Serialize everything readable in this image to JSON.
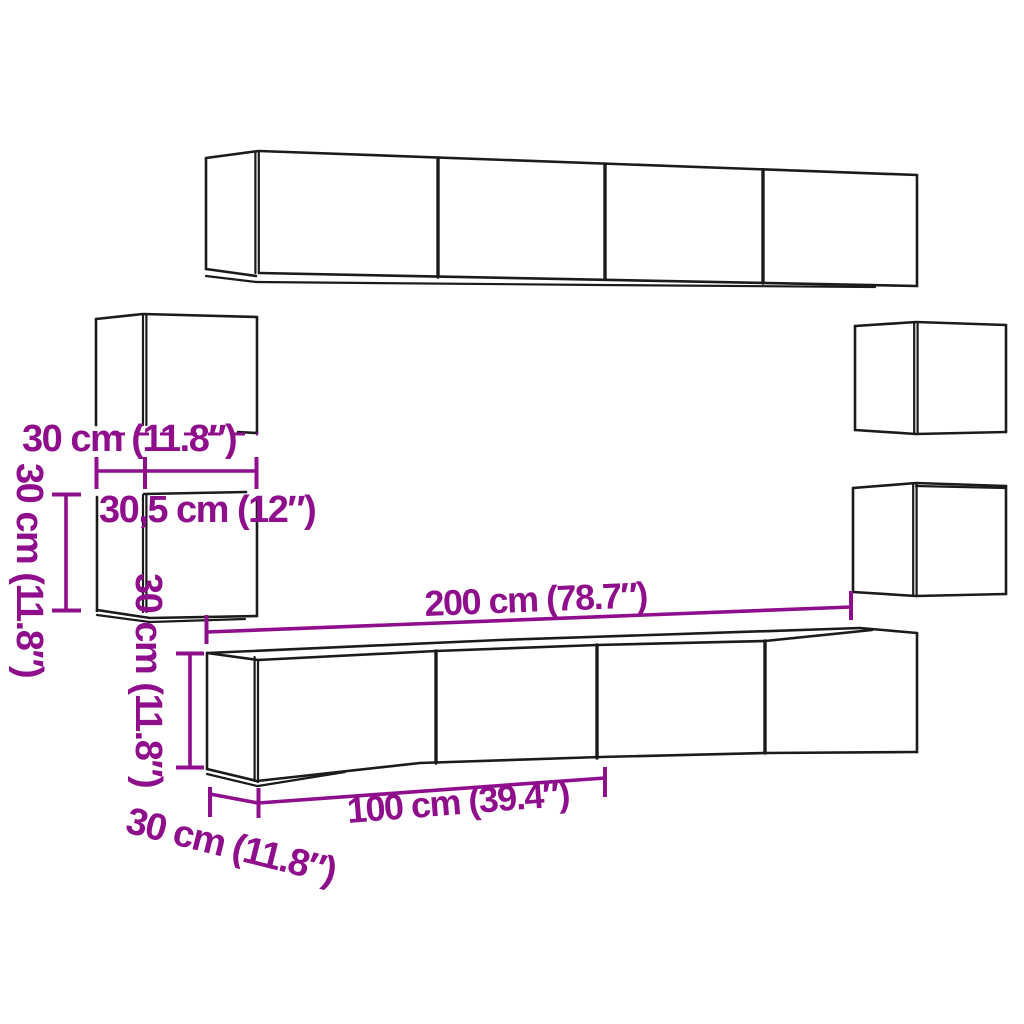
{
  "diagram": {
    "type": "furniture-dimension-diagram",
    "background_color": "#ffffff",
    "outline_color": "#1b1b1b",
    "accent_color": "#8F0E8C",
    "labels": {
      "upper_left_cabinet_height": "30 cm (11.8″)",
      "lower_left_cabinet_height": "30 cm (11.8″)",
      "left_cabinet_width": "30,5 cm (12″)",
      "tv_cabinet_height": "30 cm (11.8″)",
      "total_width": "200 cm (78.7″)",
      "tv_cabinet_width": "100 cm (39.4″)",
      "cabinet_depth": "30 cm (11.8″)"
    }
  }
}
